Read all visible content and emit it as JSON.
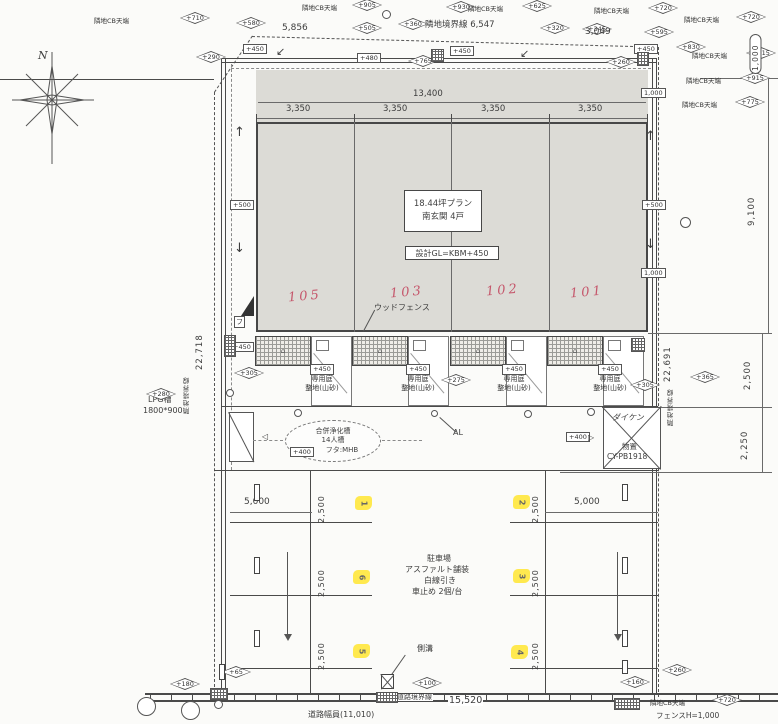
{
  "palette": {
    "ink": "#3f3f3f",
    "red": "#c5566b",
    "yellow": "#ffe94f",
    "paper": "#fbfbf9",
    "building_fill": "#dcdbd6"
  },
  "compass": {
    "north": "N"
  },
  "cb_text": "隣地CB天端",
  "building": {
    "plan_line1": "18.44坪プラン",
    "plan_line2": "南玄関 4戸",
    "gl_note": "設計GL=KBM+450"
  },
  "parking": {
    "l1": "駐車場",
    "l2": "アスファルト舗装",
    "l3": "白線引き",
    "l4": "車止め 2個/台"
  },
  "septic": {
    "l1": "合併浄化槽",
    "l2": "14人槽",
    "l3": "フタ:MHB"
  },
  "shed": {
    "brand": "ダイケン",
    "l1": "物置",
    "l2": "CY-PB1918"
  },
  "lpg": {
    "l1": "LPG槽",
    "l2": "1800*900"
  },
  "road": {
    "boundary": "道路境界線",
    "dim": "15,520",
    "width_note": "道路幅員(11,010)",
    "fence_note": "フェンスH=1,000"
  },
  "misc": {
    "wood_fence": "ウッドフェンス",
    "al": "AL",
    "gutter": "側溝",
    "fu": "フ"
  },
  "garden": {
    "lv": "+450",
    "l1": "専用庭",
    "l2": "整地(山砂)",
    "xs": [
      322,
      418,
      514,
      610
    ]
  },
  "elements": {
    "diamonds": [
      {
        "x": 236,
        "y": 17,
        "v": "+580"
      },
      {
        "x": 352,
        "y": 22,
        "v": "+505"
      },
      {
        "x": 196,
        "y": 51,
        "v": "+290"
      },
      {
        "x": 446,
        "y": 1,
        "v": "+930"
      },
      {
        "x": 398,
        "y": 18,
        "v": "+360"
      },
      {
        "x": 540,
        "y": 22,
        "v": "+320"
      },
      {
        "x": 582,
        "y": 23,
        "v": "+345"
      },
      {
        "x": 644,
        "y": 26,
        "v": "+595"
      },
      {
        "x": 676,
        "y": 41,
        "v": "+830"
      },
      {
        "x": 408,
        "y": 55,
        "v": "+765"
      },
      {
        "x": 606,
        "y": 56,
        "v": "+260"
      },
      {
        "x": 146,
        "y": 388,
        "v": "+280"
      },
      {
        "x": 234,
        "y": 367,
        "v": "+305"
      },
      {
        "x": 441,
        "y": 374,
        "v": "+275"
      },
      {
        "x": 630,
        "y": 379,
        "v": "+305"
      },
      {
        "x": 690,
        "y": 371,
        "v": "+365"
      },
      {
        "x": 412,
        "y": 677,
        "v": "+100"
      },
      {
        "x": 221,
        "y": 666,
        "v": "+65"
      },
      {
        "x": 170,
        "y": 678,
        "v": "+180"
      },
      {
        "x": 620,
        "y": 676,
        "v": "+160"
      },
      {
        "x": 662,
        "y": 664,
        "v": "+260"
      }
    ],
    "cb": [
      {
        "x": 94,
        "y": 15,
        "dx": 86,
        "v": "+710"
      },
      {
        "x": 302,
        "y": 2,
        "dx": 50,
        "v": "+905"
      },
      {
        "x": 468,
        "y": 3,
        "dx": 54,
        "v": "+625"
      },
      {
        "x": 594,
        "y": 5,
        "dx": 54,
        "v": "+720"
      },
      {
        "x": 684,
        "y": 14,
        "dx": 52,
        "v": "+720"
      },
      {
        "x": 692,
        "y": 50,
        "dx": 54,
        "v": "+915"
      },
      {
        "x": 686,
        "y": 75,
        "dx": 54,
        "v": "+915"
      },
      {
        "x": 682,
        "y": 99,
        "dx": 53,
        "v": "+775"
      },
      {
        "x": 650,
        "y": 697,
        "dx": 62,
        "v": "+720"
      }
    ],
    "boxes": [
      {
        "x": 243,
        "y": 44,
        "v": "+450"
      },
      {
        "x": 357,
        "y": 53,
        "v": "+480"
      },
      {
        "x": 450,
        "y": 46,
        "v": "+450"
      },
      {
        "x": 634,
        "y": 44,
        "v": "+450"
      },
      {
        "x": 230,
        "y": 200,
        "v": "+500"
      },
      {
        "x": 642,
        "y": 200,
        "v": "+500"
      },
      {
        "x": 230,
        "y": 342,
        "v": "+450"
      },
      {
        "x": 641,
        "y": 88,
        "v": "1,000"
      },
      {
        "x": 641,
        "y": 268,
        "v": "1,000"
      },
      {
        "x": 566,
        "y": 432,
        "v": "+400"
      },
      {
        "x": 290,
        "y": 447,
        "v": "+400"
      }
    ],
    "texts": [
      {
        "x": 38,
        "y": 50,
        "v": "N",
        "s": 11,
        "i": 1
      },
      {
        "x": 282,
        "y": 24,
        "v": "5,856",
        "s": 9
      },
      {
        "x": 425,
        "y": 21,
        "v": "隣地境界線 6,547",
        "s": 8.5
      },
      {
        "x": 585,
        "y": 28,
        "v": "3,049",
        "s": 9
      },
      {
        "x": 413,
        "y": 90,
        "v": "13,400",
        "s": 8.5
      },
      {
        "x": 286,
        "y": 105,
        "v": "3,350",
        "s": 8.5
      },
      {
        "x": 383,
        "y": 105,
        "v": "3,350",
        "s": 8.5
      },
      {
        "x": 481,
        "y": 105,
        "v": "3,350",
        "s": 8.5
      },
      {
        "x": 578,
        "y": 105,
        "v": "3,350",
        "s": 8.5
      },
      {
        "x": 244,
        "y": 498,
        "v": "5,000",
        "s": 9
      },
      {
        "x": 574,
        "y": 498,
        "v": "5,000",
        "s": 9
      },
      {
        "x": 276,
        "y": 46,
        "v": "↙",
        "s": 11
      },
      {
        "x": 520,
        "y": 48,
        "v": "↙",
        "s": 11
      },
      {
        "x": 234,
        "y": 126,
        "v": "↑",
        "s": 13
      },
      {
        "x": 234,
        "y": 242,
        "v": "↓",
        "s": 13
      },
      {
        "x": 645,
        "y": 130,
        "v": "↑",
        "s": 13
      },
      {
        "x": 645,
        "y": 238,
        "v": "↓",
        "s": 13
      },
      {
        "x": 588,
        "y": 434,
        "v": "▷",
        "s": 8
      },
      {
        "x": 262,
        "y": 433,
        "v": "◁",
        "s": 8
      }
    ],
    "vtexts": [
      {
        "x": 196,
        "y": 300,
        "h": 70,
        "v": "22,718",
        "s": 8.5
      },
      {
        "x": 184,
        "y": 358,
        "h": 56,
        "v": "隣地境界線",
        "s": 6.5
      },
      {
        "x": 664,
        "y": 312,
        "h": 70,
        "v": "22,691",
        "s": 8.5
      },
      {
        "x": 668,
        "y": 374,
        "h": 52,
        "v": "隣地境界線",
        "s": 6.5
      },
      {
        "x": 748,
        "y": 162,
        "h": 64,
        "v": "9,100",
        "s": 8.5
      },
      {
        "x": 744,
        "y": 338,
        "h": 52,
        "v": "2,500",
        "s": 8.5
      },
      {
        "x": 741,
        "y": 408,
        "h": 52,
        "v": "2,250",
        "s": 8.5
      },
      {
        "x": 318,
        "y": 477,
        "h": 46,
        "v": "2,500",
        "s": 8
      },
      {
        "x": 318,
        "y": 551,
        "h": 46,
        "v": "2,500",
        "s": 8
      },
      {
        "x": 318,
        "y": 624,
        "h": 46,
        "v": "2,500",
        "s": 8
      },
      {
        "x": 532,
        "y": 477,
        "h": 46,
        "v": "2,500",
        "s": 8
      },
      {
        "x": 532,
        "y": 551,
        "h": 46,
        "v": "2,500",
        "s": 8
      },
      {
        "x": 532,
        "y": 624,
        "h": 46,
        "v": "2,500",
        "s": 8
      },
      {
        "x": 750,
        "y": 34,
        "h": 40,
        "v": "1,000",
        "s": 7.5,
        "pill": 1
      }
    ],
    "yellows": [
      {
        "x": 355,
        "y": 496,
        "v": "1"
      },
      {
        "x": 513,
        "y": 495,
        "v": "2"
      },
      {
        "x": 353,
        "y": 570,
        "v": "6"
      },
      {
        "x": 513,
        "y": 569,
        "v": "3"
      },
      {
        "x": 353,
        "y": 644,
        "v": "5"
      },
      {
        "x": 511,
        "y": 645,
        "v": "4"
      }
    ],
    "reds": [
      {
        "x": 288,
        "y": 289,
        "v": "105"
      },
      {
        "x": 390,
        "y": 285,
        "v": "103"
      },
      {
        "x": 486,
        "y": 283,
        "v": "102"
      },
      {
        "x": 570,
        "y": 285,
        "v": "101"
      }
    ],
    "circles": [
      {
        "x": 382,
        "y": 10,
        "d": 9
      },
      {
        "x": 680,
        "y": 217,
        "d": 11
      },
      {
        "x": 226,
        "y": 389,
        "d": 8
      },
      {
        "x": 294,
        "y": 409,
        "d": 8
      },
      {
        "x": 431,
        "y": 410,
        "d": 7
      },
      {
        "x": 524,
        "y": 410,
        "d": 8
      },
      {
        "x": 587,
        "y": 408,
        "d": 8
      },
      {
        "x": 137,
        "y": 697,
        "d": 19
      },
      {
        "x": 181,
        "y": 701,
        "d": 19
      },
      {
        "x": 214,
        "y": 700,
        "d": 9
      }
    ],
    "hatches": [
      {
        "x": 431,
        "y": 49,
        "w": 13,
        "h": 13
      },
      {
        "x": 637,
        "y": 52,
        "w": 12,
        "h": 14
      },
      {
        "x": 224,
        "y": 335,
        "w": 12,
        "h": 22
      },
      {
        "x": 631,
        "y": 338,
        "w": 14,
        "h": 14
      },
      {
        "x": 376,
        "y": 692,
        "w": 22,
        "h": 11
      },
      {
        "x": 614,
        "y": 698,
        "w": 26,
        "h": 12
      },
      {
        "x": 210,
        "y": 688,
        "w": 18,
        "h": 12
      }
    ],
    "bars": [
      {
        "x": 254,
        "y": 484,
        "w": 6,
        "h": 17
      },
      {
        "x": 254,
        "y": 557,
        "w": 6,
        "h": 17
      },
      {
        "x": 254,
        "y": 630,
        "w": 6,
        "h": 17
      },
      {
        "x": 622,
        "y": 484,
        "w": 6,
        "h": 17
      },
      {
        "x": 622,
        "y": 557,
        "w": 6,
        "h": 17
      },
      {
        "x": 622,
        "y": 630,
        "w": 6,
        "h": 17
      },
      {
        "x": 622,
        "y": 660,
        "w": 6,
        "h": 14
      },
      {
        "x": 219,
        "y": 664,
        "w": 6,
        "h": 16
      }
    ],
    "arrows": [
      {
        "x": 287,
        "y": 552,
        "h": 86
      },
      {
        "x": 617,
        "y": 552,
        "h": 86
      }
    ]
  }
}
